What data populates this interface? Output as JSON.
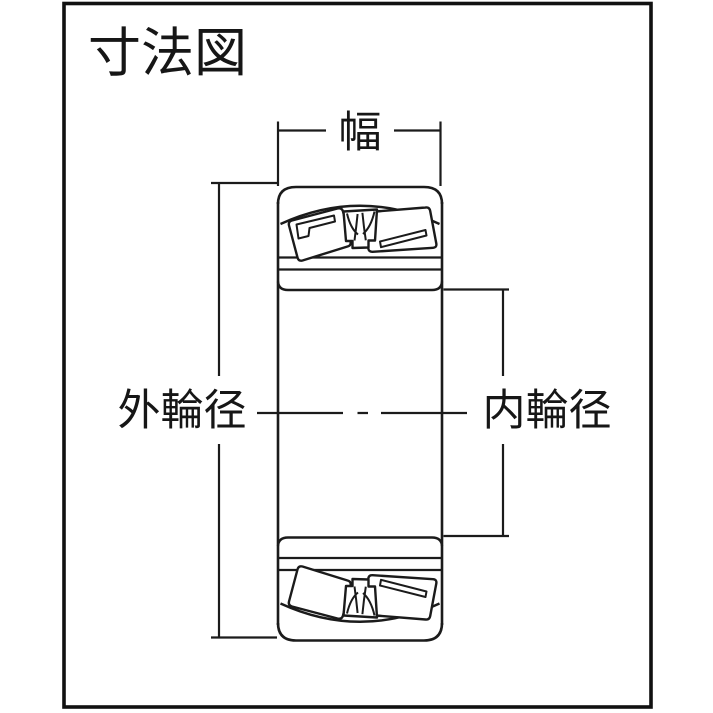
{
  "title": "寸法図",
  "labels": {
    "width": "幅",
    "outer_diameter": "外輪径",
    "inner_diameter": "内輪径"
  },
  "colors": {
    "line": "#1b1b1b",
    "border": "#111111",
    "background": "#ffffff"
  }
}
